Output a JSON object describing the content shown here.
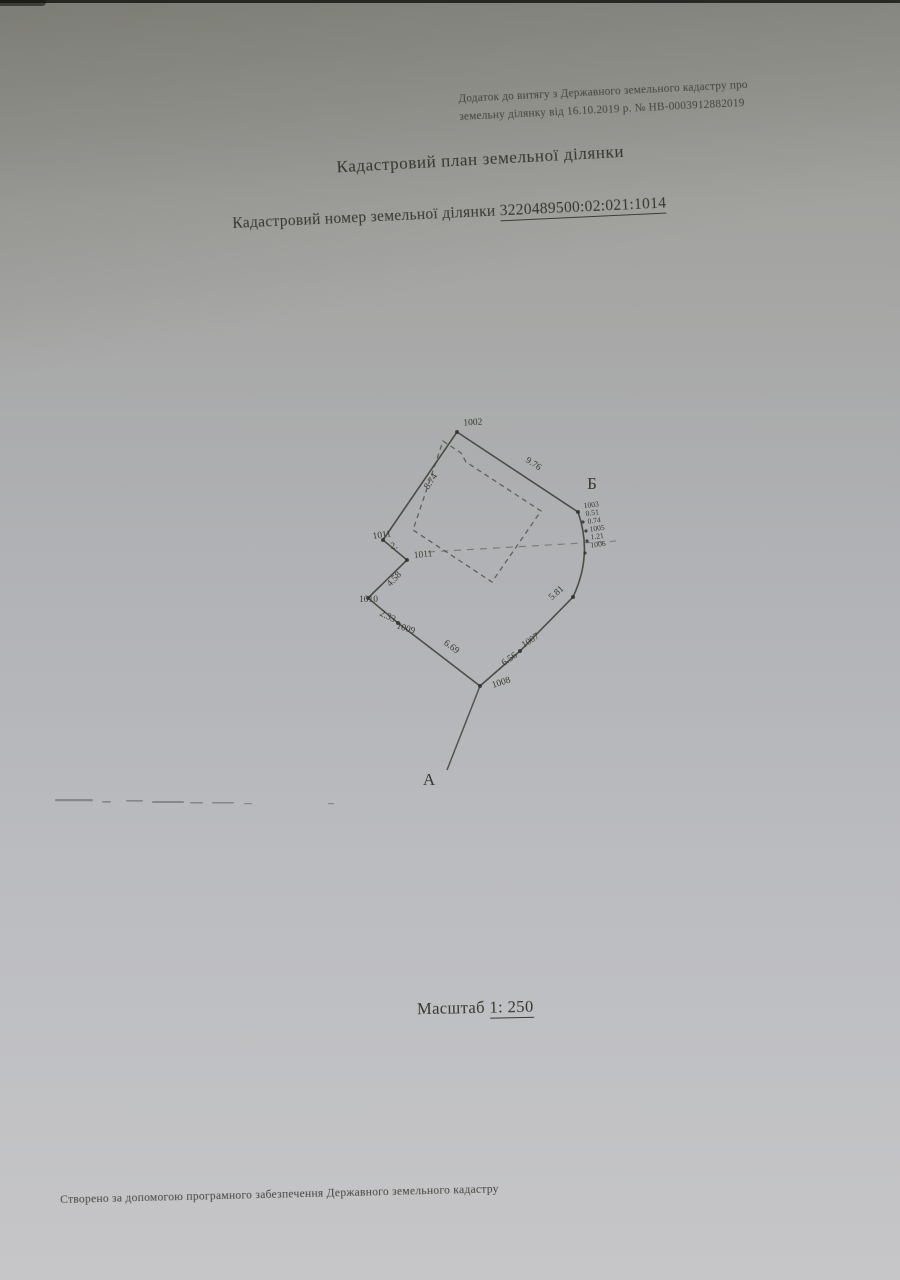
{
  "scan": {
    "header_note": {
      "line1": "Додаток до витягу з Державного земельного кадастру про",
      "line2": "земельну ділянку від 16.10.2019 р. № НВ-0003912882019"
    },
    "title": "Кадастровий план земельної ділянки",
    "cadastral": {
      "label": "Кадастровий номер земельної ділянки",
      "number": "3220489500:02:021:1014"
    },
    "scale": {
      "label": "Масштаб",
      "value": "1: 250"
    },
    "footer": "Створено за допомогою програмного забезпечення Державного земельного кадастру",
    "ink_color": "#35352d",
    "paper_color_top": "#8f9089",
    "paper_color_bottom": "#c6c6c8"
  },
  "plan": {
    "corners": {
      "B": "Б",
      "A": "А"
    },
    "points": {
      "p1002": "1002",
      "p1007": "1007",
      "p1008": "1008",
      "p1009": "1009",
      "p1010": "1010",
      "p1011a": "1011",
      "p1011b": "1011"
    },
    "cluster": {
      "l1": "1003",
      "l2": "0.51",
      "l3": "0.74",
      "l4": "1005",
      "l5": "1.21",
      "l6": "1006"
    },
    "measurements": {
      "m976": "9.76",
      "m874": "8.74",
      "m2": "2.",
      "m458": "4.58",
      "m233": "2.33",
      "m669": "6.69",
      "m656": "6.56",
      "m581": "5.81"
    }
  }
}
